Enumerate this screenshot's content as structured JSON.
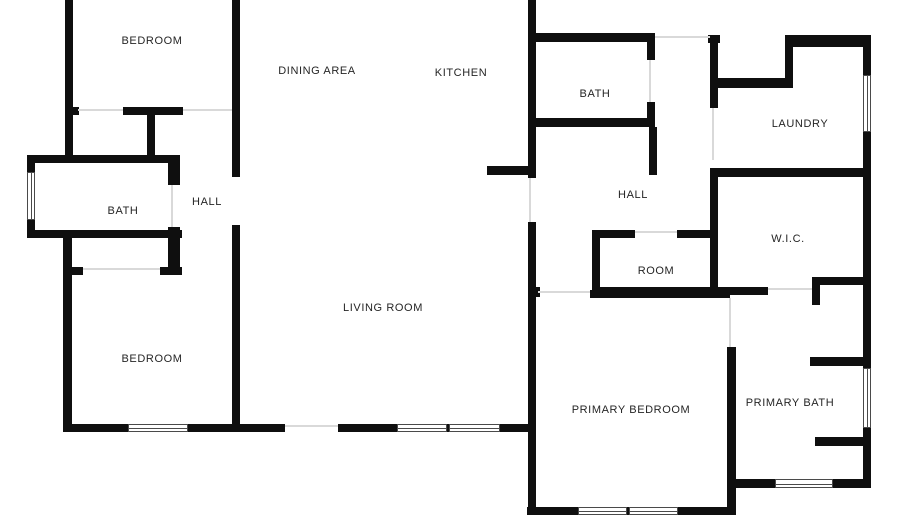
{
  "plan": {
    "background": "#ffffff",
    "wall_color": "#0f0f0f",
    "opening_color": "#d9d9d9",
    "window_border_color": "#4a4a4a",
    "window_fill": "#ffffff",
    "label_color": "#252525",
    "rooms": [
      {
        "label": "BEDROOM",
        "x": 152,
        "y": 41
      },
      {
        "label": "DINING AREA",
        "x": 317,
        "y": 71
      },
      {
        "label": "KITCHEN",
        "x": 461,
        "y": 73
      },
      {
        "label": "BATH",
        "x": 595,
        "y": 94
      },
      {
        "label": "LAUNDRY",
        "x": 800,
        "y": 124
      },
      {
        "label": "HALL",
        "x": 633,
        "y": 195
      },
      {
        "label": "BATH",
        "x": 123,
        "y": 211
      },
      {
        "label": "HALL",
        "x": 207,
        "y": 202
      },
      {
        "label": "W.I.C.",
        "x": 788,
        "y": 239
      },
      {
        "label": "ROOM",
        "x": 656,
        "y": 271
      },
      {
        "label": "LIVING ROOM",
        "x": 383,
        "y": 308
      },
      {
        "label": "BEDROOM",
        "x": 152,
        "y": 359
      },
      {
        "label": "PRIMARY BEDROOM",
        "x": 631,
        "y": 410
      },
      {
        "label": "PRIMARY BATH",
        "x": 790,
        "y": 403
      }
    ],
    "walls": [
      [
        65,
        0,
        8,
        158
      ],
      [
        232,
        0,
        8,
        177
      ],
      [
        65,
        107,
        14,
        8
      ],
      [
        123,
        107,
        60,
        8
      ],
      [
        147,
        107,
        8,
        50
      ],
      [
        27,
        155,
        153,
        8
      ],
      [
        27,
        163,
        8,
        9
      ],
      [
        27,
        220,
        8,
        18
      ],
      [
        168,
        163,
        12,
        22
      ],
      [
        168,
        227,
        12,
        48
      ],
      [
        27,
        230,
        155,
        8
      ],
      [
        63,
        267,
        20,
        8
      ],
      [
        160,
        267,
        22,
        8
      ],
      [
        63,
        235,
        9,
        197
      ],
      [
        232,
        225,
        8,
        207
      ],
      [
        63,
        424,
        65,
        8
      ],
      [
        188,
        424,
        97,
        8
      ],
      [
        338,
        424,
        59,
        8
      ],
      [
        447,
        424,
        2,
        8
      ],
      [
        500,
        424,
        36,
        8
      ],
      [
        528,
        0,
        8,
        178
      ],
      [
        528,
        222,
        8,
        293
      ],
      [
        487,
        166,
        49,
        9
      ],
      [
        536,
        33,
        119,
        9
      ],
      [
        647,
        33,
        8,
        27
      ],
      [
        647,
        102,
        8,
        25
      ],
      [
        528,
        118,
        127,
        9
      ],
      [
        649,
        127,
        8,
        48
      ],
      [
        708,
        35,
        12,
        8
      ],
      [
        710,
        35,
        8,
        73
      ],
      [
        718,
        78,
        75,
        10
      ],
      [
        785,
        35,
        8,
        53
      ],
      [
        785,
        35,
        85,
        12
      ],
      [
        863,
        35,
        8,
        40
      ],
      [
        863,
        132,
        8,
        236
      ],
      [
        863,
        428,
        8,
        59
      ],
      [
        710,
        168,
        160,
        9
      ],
      [
        710,
        177,
        8,
        118
      ],
      [
        592,
        230,
        43,
        8
      ],
      [
        677,
        230,
        35,
        8
      ],
      [
        592,
        230,
        8,
        65
      ],
      [
        592,
        287,
        120,
        8
      ],
      [
        710,
        287,
        58,
        8
      ],
      [
        812,
        277,
        8,
        28
      ],
      [
        812,
        277,
        55,
        8
      ],
      [
        528,
        287,
        12,
        10
      ],
      [
        590,
        290,
        140,
        8
      ],
      [
        727,
        347,
        9,
        168
      ],
      [
        810,
        357,
        53,
        9
      ],
      [
        815,
        437,
        56,
        9
      ],
      [
        736,
        479,
        39,
        9
      ],
      [
        833,
        479,
        38,
        9
      ],
      [
        527,
        507,
        51,
        8
      ],
      [
        627,
        507,
        2,
        8
      ],
      [
        678,
        507,
        58,
        8
      ]
    ],
    "windows": [
      {
        "x": 27,
        "y": 172,
        "w": 8,
        "h": 48,
        "dir": "v",
        "name": "bath-left-window"
      },
      {
        "x": 863,
        "y": 75,
        "w": 8,
        "h": 57,
        "dir": "v",
        "name": "laundry-window"
      },
      {
        "x": 863,
        "y": 368,
        "w": 8,
        "h": 60,
        "dir": "v",
        "name": "primary-bath-side-window"
      },
      {
        "x": 128,
        "y": 424,
        "w": 60,
        "h": 8,
        "dir": "h",
        "name": "bedroom2-window"
      },
      {
        "x": 397,
        "y": 424,
        "w": 50,
        "h": 8,
        "dir": "h",
        "name": "living-room-window-1"
      },
      {
        "x": 449,
        "y": 424,
        "w": 51,
        "h": 8,
        "dir": "h",
        "name": "living-room-window-2"
      },
      {
        "x": 578,
        "y": 507,
        "w": 49,
        "h": 8,
        "dir": "h",
        "name": "primary-bedroom-window-1"
      },
      {
        "x": 629,
        "y": 507,
        "w": 49,
        "h": 8,
        "dir": "h",
        "name": "primary-bedroom-window-2"
      },
      {
        "x": 775,
        "y": 479,
        "w": 58,
        "h": 9,
        "dir": "h",
        "name": "primary-bath-bottom-window"
      }
    ],
    "openings": [
      [
        78,
        109,
        45,
        2
      ],
      [
        183,
        109,
        49,
        2
      ],
      [
        171,
        185,
        2,
        42
      ],
      [
        83,
        268,
        77,
        2
      ],
      [
        285,
        425,
        53,
        2
      ],
      [
        529,
        178,
        2,
        44
      ],
      [
        649,
        60,
        2,
        42
      ],
      [
        655,
        36,
        55,
        2
      ],
      [
        712,
        108,
        2,
        52
      ],
      [
        635,
        231,
        42,
        2
      ],
      [
        768,
        288,
        44,
        2
      ],
      [
        538,
        291,
        52,
        2
      ],
      [
        729,
        298,
        2,
        49
      ]
    ]
  }
}
